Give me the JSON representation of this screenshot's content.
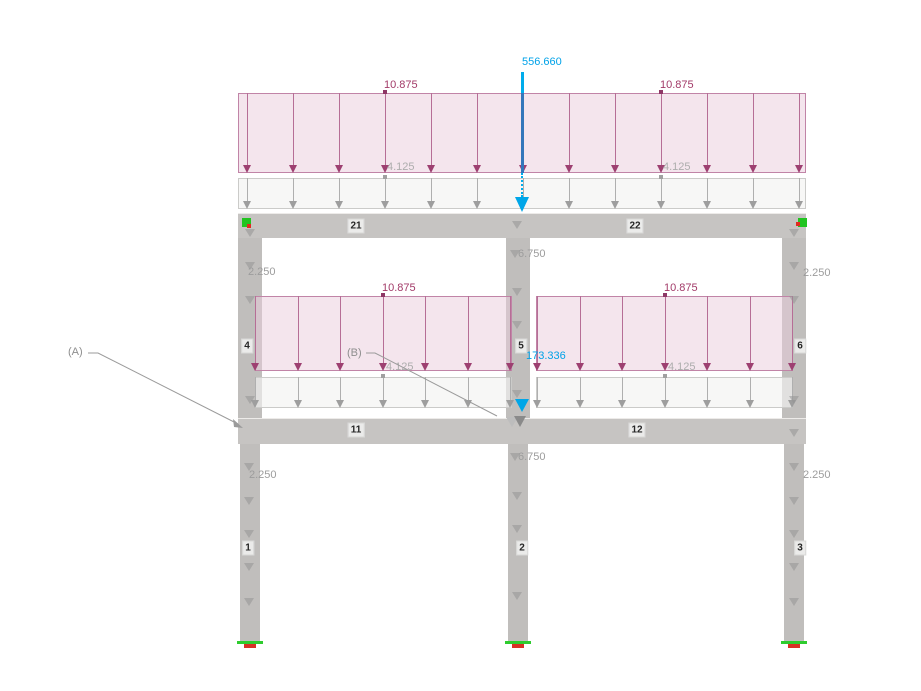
{
  "view": {
    "width": 921,
    "height": 691,
    "bg": "#FFFFFF"
  },
  "colors": {
    "beam": "#C6C4C2",
    "beam_edge": "#EDEBE9",
    "column": "#C0BEBC",
    "member_label_bg": "#EBEBEA",
    "member_label_border": "#D8D8D7",
    "member_label_text": "#262626",
    "pink_fill": "rgba(233,203,219,0.50)",
    "pink_border": "#C184A7",
    "pink_stem": "#B66E96",
    "pink_head": "#9D4071",
    "pink_dot": "#8E3766",
    "pink_text": "#A23A68",
    "gray_fill": "rgba(243,243,241,0.65)",
    "gray_border": "#CBCBC9",
    "gray_stem": "#AFAFAF",
    "gray_head": "#9E9E9E",
    "gray_dot": "#A0A0A0",
    "gray_text": "#ADADAD",
    "col_tri": "rgba(148,148,148,0.55)",
    "col_load_text": "#9C9C9C",
    "blue_text": "#00A2E8",
    "blue_stem_dark": "#3377BB",
    "blue_stem_bright": "#00ACEC",
    "blue_head": "#00A6E8",
    "leader": "#9B9B9B",
    "annot_text": "#8E8E8E",
    "node_green": "#21C421",
    "node_red": "#E02B1F",
    "support_green": "#2ECC2E",
    "support_red": "#D93025",
    "junction_light": "#BDBDBD",
    "junction_dark": "#8A8A8A"
  },
  "members": {
    "beams": [
      {
        "id": "beam-21-22",
        "x": 238,
        "y": 213,
        "w": 568,
        "h": 25
      },
      {
        "id": "beam-11-12",
        "x": 238,
        "y": 418,
        "w": 568,
        "h": 26
      }
    ],
    "columns": [
      {
        "id": "column-4",
        "x": 238,
        "y": 238,
        "w": 24,
        "h": 180
      },
      {
        "id": "column-5",
        "x": 506,
        "y": 238,
        "w": 24,
        "h": 180
      },
      {
        "id": "column-6",
        "x": 782,
        "y": 238,
        "w": 24,
        "h": 180
      },
      {
        "id": "column-1",
        "x": 240,
        "y": 444,
        "w": 20,
        "h": 197
      },
      {
        "id": "column-2",
        "x": 508,
        "y": 444,
        "w": 20,
        "h": 197
      },
      {
        "id": "column-3",
        "x": 784,
        "y": 444,
        "w": 20,
        "h": 197
      }
    ],
    "labels": [
      {
        "text": "21",
        "cx": 356,
        "cy": 226
      },
      {
        "text": "22",
        "cx": 635,
        "cy": 226
      },
      {
        "text": "11",
        "cx": 356,
        "cy": 430
      },
      {
        "text": "12",
        "cx": 637,
        "cy": 430
      },
      {
        "text": "4",
        "cx": 247,
        "cy": 346
      },
      {
        "text": "5",
        "cx": 521,
        "cy": 346
      },
      {
        "text": "6",
        "cx": 800,
        "cy": 346
      },
      {
        "text": "1",
        "cx": 248,
        "cy": 548
      },
      {
        "text": "2",
        "cx": 522,
        "cy": 548
      },
      {
        "text": "3",
        "cx": 800,
        "cy": 548
      }
    ]
  },
  "loads": {
    "primary_distributed": [
      {
        "value": "10.875",
        "x": 238,
        "y": 93,
        "w": 568,
        "h": 80,
        "head_h": 8,
        "arrows": [
          247,
          293,
          339,
          385,
          431,
          477,
          523,
          569,
          615,
          661,
          707,
          753,
          799
        ],
        "labels": [
          {
            "text": "10.875",
            "tx": 384,
            "ty": 79,
            "dot": [
              385,
              92
            ]
          },
          {
            "text": "10.875",
            "tx": 660,
            "ty": 79,
            "dot": [
              661,
              92
            ]
          }
        ]
      },
      {
        "value": "10.875",
        "x": 255,
        "y": 296,
        "w": 257,
        "h": 75,
        "head_h": 8,
        "arrows": [
          255,
          298,
          340,
          383,
          425,
          468,
          510
        ],
        "labels": [
          {
            "text": "10.875",
            "tx": 382,
            "ty": 282,
            "dot": [
              383,
              295
            ]
          }
        ]
      },
      {
        "value": "10.875",
        "x": 536,
        "y": 296,
        "w": 257,
        "h": 75,
        "head_h": 8,
        "arrows": [
          537,
          580,
          622,
          665,
          707,
          750,
          792
        ],
        "labels": [
          {
            "text": "10.875",
            "tx": 664,
            "ty": 282,
            "dot": [
              665,
              295
            ]
          }
        ]
      }
    ],
    "secondary_distributed": [
      {
        "value": "4.125",
        "x": 238,
        "y": 178,
        "w": 568,
        "h": 31,
        "head_h": 8,
        "arrows": [
          247,
          293,
          339,
          385,
          431,
          477,
          523,
          569,
          615,
          661,
          707,
          753,
          799
        ],
        "labels": [
          {
            "text": "4.125",
            "tx": 387,
            "ty": 161,
            "dot": [
              385,
              177
            ]
          },
          {
            "text": "4.125",
            "tx": 663,
            "ty": 161,
            "dot": [
              661,
              177
            ]
          }
        ]
      },
      {
        "value": "4.125",
        "x": 255,
        "y": 377,
        "w": 257,
        "h": 31,
        "head_h": 8,
        "arrows": [
          255,
          298,
          340,
          383,
          425,
          468,
          510
        ],
        "labels": [
          {
            "text": "4.125",
            "tx": 386,
            "ty": 361,
            "dot": [
              383,
              376
            ]
          }
        ]
      },
      {
        "value": "4.125",
        "x": 536,
        "y": 377,
        "w": 257,
        "h": 31,
        "head_h": 8,
        "arrows": [
          537,
          580,
          622,
          665,
          707,
          750,
          792
        ],
        "labels": [
          {
            "text": "4.125",
            "tx": 668,
            "ty": 361,
            "dot": [
              665,
              376
            ]
          }
        ]
      }
    ],
    "column_triangles": [
      {
        "x": 245,
        "ys": [
          229,
          262,
          296,
          396
        ]
      },
      {
        "x": 789,
        "ys": [
          229,
          262,
          296,
          396
        ]
      },
      {
        "x": 512,
        "ys": [
          221,
          288,
          321,
          390
        ]
      },
      {
        "x": 244,
        "ys": [
          463,
          497,
          530,
          563,
          598
        ]
      },
      {
        "x": 789,
        "ys": [
          429,
          463,
          497,
          530,
          563,
          598
        ]
      },
      {
        "x": 512,
        "ys": [
          492,
          525,
          592
        ]
      }
    ],
    "column_load_labels": [
      {
        "text": "2.250",
        "x": 248,
        "y": 266
      },
      {
        "text": "2.250",
        "x": 803,
        "y": 267
      },
      {
        "text": "2.250",
        "x": 249,
        "y": 469
      },
      {
        "text": "2.250",
        "x": 803,
        "y": 469
      },
      {
        "text": "6.750",
        "x": 518,
        "y": 248,
        "tri": [
          510,
          250
        ]
      },
      {
        "text": "6.750",
        "x": 518,
        "y": 451,
        "tri": [
          510,
          453
        ]
      }
    ],
    "point_loads": {
      "top": {
        "value": "556.660",
        "label_x": 522,
        "label_y": 56,
        "stem_x": 521,
        "stem_bright": [
          72,
          21
        ],
        "stem_dark": [
          93,
          80
        ],
        "stem_dotted": [
          173,
          24
        ],
        "head_x": 515,
        "head_y": 197
      },
      "mid": {
        "value": "173.336",
        "label_x": 526,
        "label_y": 350,
        "head_x": 515,
        "head_y": 399
      }
    }
  },
  "annotations": [
    {
      "text": "(A)",
      "tx": 68,
      "ty": 346,
      "points": "88,353 98,353 238,424",
      "arrow_points": "243,428 233,419 234,427"
    },
    {
      "text": "(B)",
      "tx": 347,
      "ty": 347,
      "points": "366,353 375,353 497,416",
      "arrow_points": ""
    }
  ],
  "markers": {
    "nodes": [
      {
        "green": [
          242,
          218,
          9,
          9
        ],
        "red": [
          247,
          224,
          4,
          4
        ]
      },
      {
        "green": [
          798,
          218,
          9,
          9
        ],
        "red": [
          796,
          222,
          4,
          4
        ]
      }
    ],
    "supports": [
      {
        "green": [
          237,
          641,
          26,
          3
        ],
        "red": [
          244,
          644,
          12,
          4
        ]
      },
      {
        "green": [
          505,
          641,
          26,
          3
        ],
        "red": [
          512,
          644,
          12,
          4
        ]
      },
      {
        "green": [
          781,
          641,
          26,
          3
        ],
        "red": [
          788,
          644,
          12,
          4
        ]
      }
    ],
    "junction": {
      "light": [
        506,
        417
      ],
      "dark": [
        514,
        416
      ]
    }
  }
}
